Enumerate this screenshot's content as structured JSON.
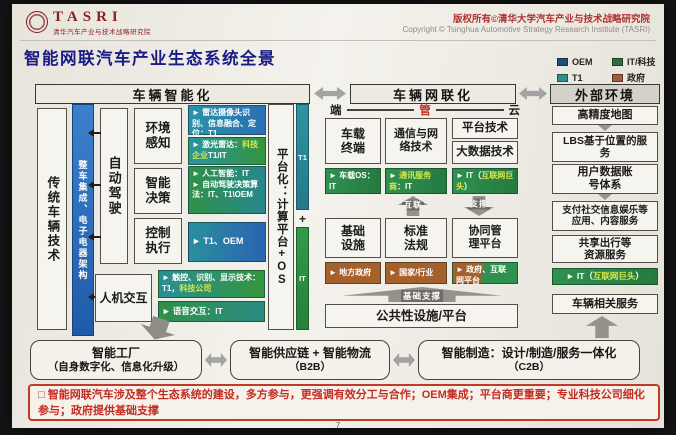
{
  "colors": {
    "oem_blue": "#1f4e79",
    "it_green": "#2d6e3f",
    "t1_teal": "#2e8f8f",
    "gov_brown": "#a05a3c",
    "accent_red": "#b03232",
    "title_navy": "#1b1b86"
  },
  "header": {
    "logo_acronym": "TASRI",
    "logo_subtitle": "清华汽车产业与技术战略研究院",
    "copyright_cn": "版权所有©清华大学汽车产业与技术战略研究院",
    "copyright_en": "Copyright © Tsinghua Automotive Strategy Research Institute (TASRI)",
    "title": "智能网联汽车产业生态系统全景"
  },
  "legend": {
    "oem": {
      "label": "OEM",
      "color": "#1f4e79"
    },
    "it": {
      "label": "IT/科技",
      "color": "#2d6e3f"
    },
    "t1": {
      "label": "T1",
      "color": "#2e8f8f"
    },
    "gov": {
      "label": "政府",
      "color": "#a05a3c"
    }
  },
  "smart": {
    "header": "车辆智能化",
    "traditional_vehicle_tech": "传统车辆技术",
    "integration_bar": "整车集成、电子电器架构",
    "auto_driving": "自动驾驶",
    "env_label": "环境感知",
    "env_item1": "► 雷达摄像头识别、信息融合、定位：T1",
    "env_item2_pre": "► 激光雷达：",
    "env_item2_hl": "科技企业",
    "env_item2_post": "T1/IT",
    "decision_label": "智能决策",
    "decision_item1": "► 人工智能：IT",
    "decision_item2": "► 自动驾驶决策算法：IT、T1\\OEM",
    "control_label": "控制执行",
    "control_item": "► T1、OEM",
    "hmi_label": "人机交互",
    "hmi_item1_pre": "► 触控、识别、显示技术：T1，",
    "hmi_item1_hl": "科技公司",
    "hmi_item2": "► 语音交互：IT",
    "platform": "平台化：计算平台+OS",
    "bar_t1": "T1",
    "bar_plus": "+",
    "bar_it": "IT"
  },
  "net": {
    "header": "车辆网联化",
    "duan": "端",
    "guan": "管",
    "yun": "云",
    "terminal": "车载终端",
    "terminal_tag": "► 车载OS：IT",
    "comm": "通信与网络技术",
    "comm_tag_pre": "► ",
    "comm_tag_hl": "通讯服务商",
    "comm_tag_post": "：IT",
    "platform_tech": "平台技术",
    "bigdata": "大数据技术",
    "cloud_tag_pre": "► IT（",
    "cloud_tag_hl": "互联网巨头",
    "cloud_tag_post": "）",
    "arrow_interlink": "互联",
    "arrow_support": "支撑",
    "infra": "基础设施",
    "standards": "标准法规",
    "coord": "协同管理平台",
    "gov1": "► 地方政府",
    "gov2": "► 国家/行业",
    "gov3_pre": "► 政府、",
    "gov3_hl": "互联网平台",
    "base_arrow": "基础支撑",
    "public": "公共性设施/平台"
  },
  "ext": {
    "header": "外部环境",
    "map": "高精度地图",
    "lbs": "LBS基于位置的服务",
    "user_data": "用户数据账号体系",
    "payment": "支付社交信息娱乐等应用、内容服务",
    "sharing": "共享出行等资源服务",
    "it_tag_pre": "► IT（",
    "it_tag_hl": "互联网巨头",
    "it_tag_post": "）",
    "vehicle_services": "车辆相关服务"
  },
  "bottom": {
    "factory_l1": "智能工厂",
    "factory_l2": "（自身数字化、信息化升级）",
    "supply_l1": "智能供应链 + 智能物流",
    "supply_l2": "（B2B）",
    "mfg_l1": "智能制造：设计/制造/服务一体化",
    "mfg_l2": "（C2B）"
  },
  "footer": {
    "note": "□ 智能网联汽车涉及整个生态系统的建设，多方参与，更强调有效分工与合作；OEM集成；平台商更重要；专业科技公司细化参与；政府提供基础支撑",
    "page_number": "7"
  }
}
